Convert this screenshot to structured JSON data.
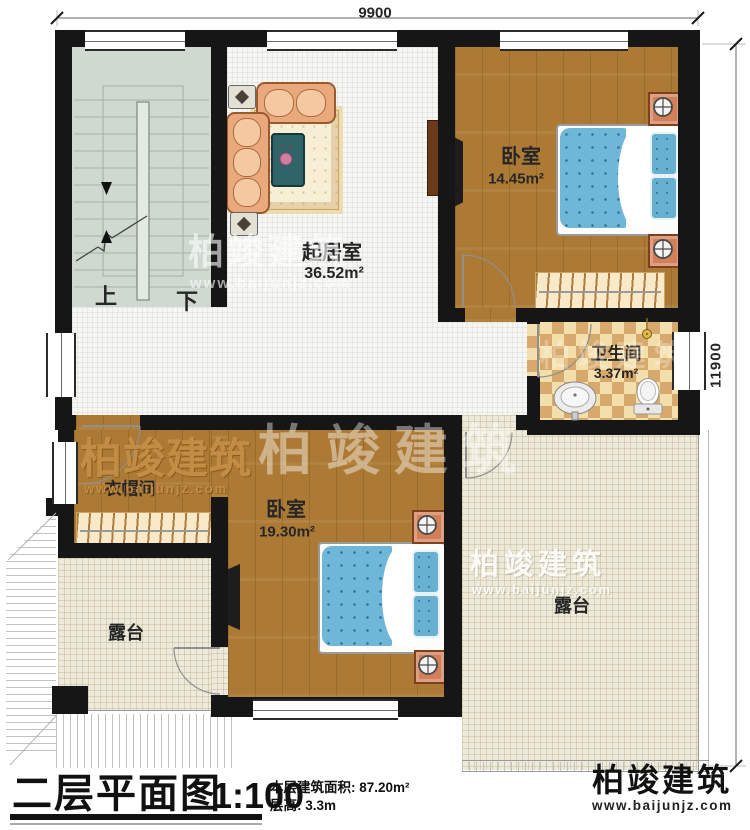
{
  "plan": {
    "dimensions": {
      "width_label": "9900",
      "height_label": "11900"
    },
    "rooms": {
      "living_room": {
        "name": "起居室",
        "area": "36.52m²"
      },
      "bedroom_top": {
        "name": "卧室",
        "area": "14.45m²"
      },
      "bathroom": {
        "name": "卫生间",
        "area": "3.37m²"
      },
      "cloakroom": {
        "name": "衣帽间"
      },
      "bedroom_bottom": {
        "name": "卧室",
        "area": "19.30m²"
      },
      "terrace_left": {
        "name": "露台"
      },
      "terrace_right": {
        "name": "露台"
      }
    },
    "stairs": {
      "up_label": "上",
      "down_label": "下"
    }
  },
  "title_block": {
    "title": "二层平面图",
    "scale": "1:100",
    "stat_area": "本层建筑面积: 87.20m²",
    "stat_height": "层高: 3.3m"
  },
  "brand": {
    "name": "柏竣建筑",
    "url": "www.baijunjz.com"
  },
  "colors": {
    "wall": "#161616",
    "wood_floor": "#ad7a35",
    "stair_floor": "#cfd9cf",
    "terrace_floor": "#eeeadb",
    "bath_tile_light": "#f3dfab",
    "bath_tile_dark": "#d8a96c",
    "bed_blue": "#6fb7d8",
    "brand_blue": "#1a5aa6",
    "brand_orange": "#f7941d"
  }
}
